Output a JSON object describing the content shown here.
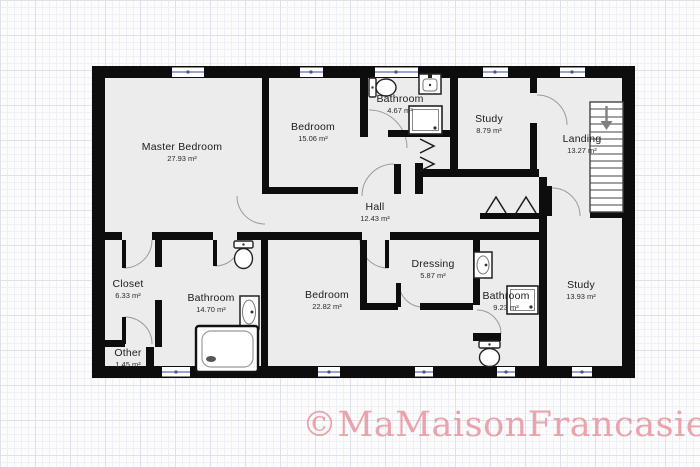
{
  "plan": {
    "rooms": [
      {
        "id": "master-bedroom",
        "name": "Master Bedroom",
        "area": "27.93 m²"
      },
      {
        "id": "bedroom-top",
        "name": "Bedroom",
        "area": "15.06 m²"
      },
      {
        "id": "bathroom-top",
        "name": "Bathroom",
        "area": "4.67 m²"
      },
      {
        "id": "study-top",
        "name": "Study",
        "area": "8.79 m²"
      },
      {
        "id": "landing",
        "name": "Landing",
        "area": "13.27 m²"
      },
      {
        "id": "hall",
        "name": "Hall",
        "area": "12.43 m²"
      },
      {
        "id": "closet",
        "name": "Closet",
        "area": "6.33 m²"
      },
      {
        "id": "bathroom-left",
        "name": "Bathroom",
        "area": "14.70 m²"
      },
      {
        "id": "other",
        "name": "Other",
        "area": "1.45 m²"
      },
      {
        "id": "bedroom-bottom",
        "name": "Bedroom",
        "area": "22.82 m²"
      },
      {
        "id": "dressing",
        "name": "Dressing",
        "area": "5.87 m²"
      },
      {
        "id": "bathroom-right",
        "name": "Bathroom",
        "area": "9.23 m²"
      },
      {
        "id": "study-right",
        "name": "Study",
        "area": "13.93 m²"
      }
    ],
    "fixture_icons": [
      "toilet-icon",
      "sink-icon",
      "shower-icon",
      "bathtub-icon",
      "stairs-icon",
      "stairs-direction-arrow-icon",
      "door-swing-icon",
      "folding-door-icon",
      "window-icon"
    ]
  },
  "watermark": {
    "text": "©MaMaisonFrancasie"
  },
  "colors": {
    "wall": "#0d0d0d",
    "floor": "#ececec",
    "window_accent": "#9aa3d4",
    "watermark": "#e8909b",
    "label_text": "#1b1b1b"
  }
}
